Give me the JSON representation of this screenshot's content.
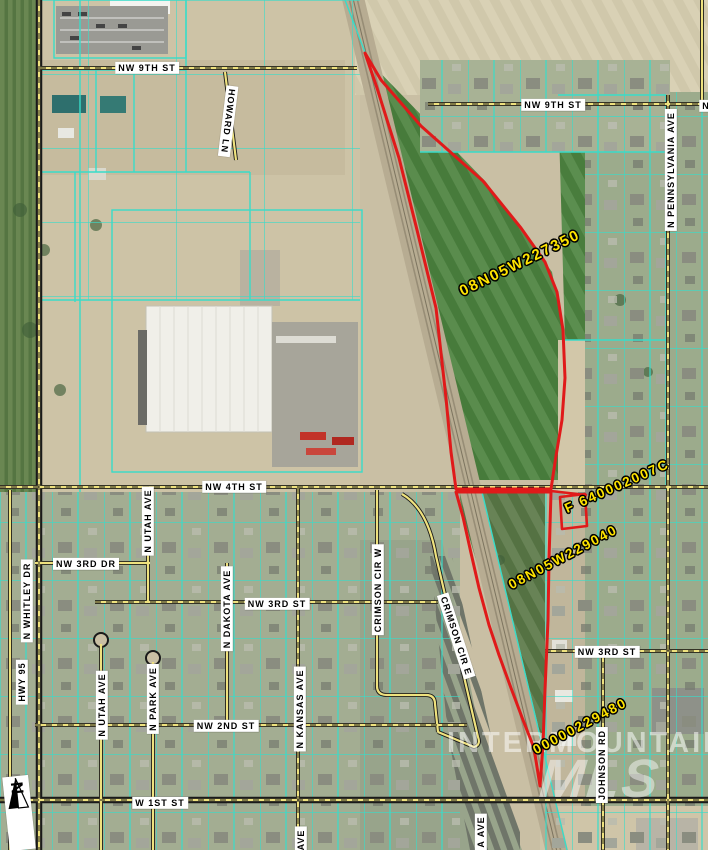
{
  "map": {
    "streets": [
      "NW 9TH ST",
      "NW 9TH ST",
      "N",
      "HOWARD LN",
      "N PENNSYLVANIA AVE",
      "NW 4TH ST",
      "N UTAH AVE",
      "NW 3RD DR",
      "N WHITLEY DR",
      "HWY 95",
      "N DAKOTA AVE",
      "NW 3RD ST",
      "CRIMSON CIR W",
      "CRIMSON CIR E",
      "NW 3RD ST",
      "N UTAH AVE",
      "N PARK AVE",
      "N KANSAS AVE",
      "NW 2ND ST",
      "JOHNSON RD",
      "W 1ST ST",
      "AVE",
      "A AVE"
    ],
    "parcel_ids": [
      "08N05W227350",
      "F 640002007C",
      "08N05W229040",
      "00000229480"
    ],
    "watermark": {
      "line1": "INTERMOUNTAIN",
      "line2": "MLS"
    },
    "north_arrow_label": "N",
    "colors": {
      "parcel_boundary_cyan": "#38dcc9",
      "highlight_parcel_red": "#e01a1a",
      "parcel_id_yellow": "#ffe400",
      "road_yellow": "#efe27e",
      "street_label_bg": "#ffffff",
      "street_label_text": "#000000"
    }
  }
}
